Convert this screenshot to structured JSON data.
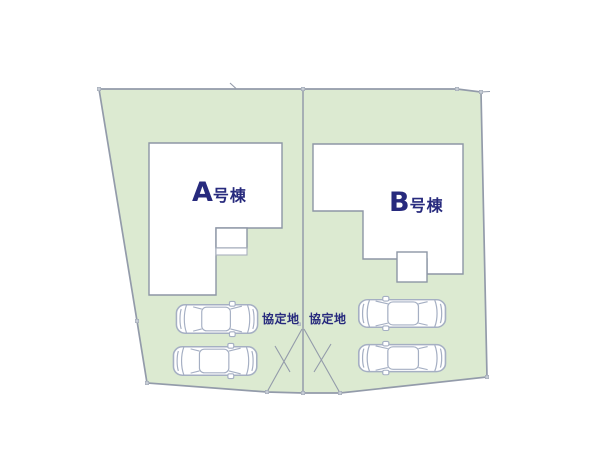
{
  "colors": {
    "plot_fill": "#dcead1",
    "boundary_line": "#939baa",
    "building_line": "#8d96a6",
    "porch_line": "#a9b0be",
    "car_line": "#a5afc3",
    "marker": "#c6ccd5",
    "label_text": "#272a7d"
  },
  "plot": {
    "buildings": [
      {
        "id": "A",
        "label_prefix": "A",
        "label_suffix": "号棟"
      },
      {
        "id": "B",
        "label_prefix": "B",
        "label_suffix": "号棟"
      }
    ],
    "agreement_labels": [
      {
        "text": "協定地"
      },
      {
        "text": "協定地"
      }
    ]
  }
}
